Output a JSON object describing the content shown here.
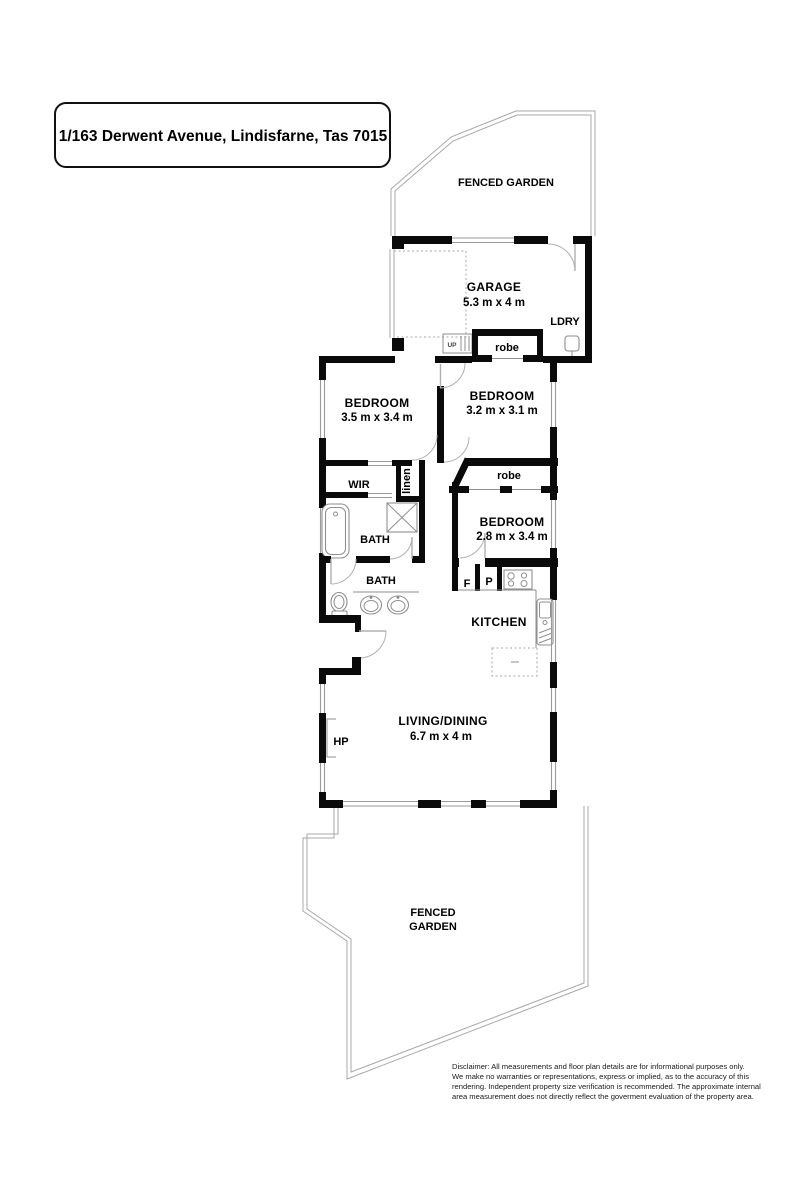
{
  "title": "1/163 Derwent Avenue, Lindisfarne, Tas 7015",
  "garden_top_label": "FENCED GARDEN",
  "garden_bottom_label_1": "FENCED",
  "garden_bottom_label_2": "GARDEN",
  "rooms": {
    "garage": {
      "name": "GARAGE",
      "dims": "5.3 m x 4 m"
    },
    "bedroom1": {
      "name": "BEDROOM",
      "dims": "3.5 m x 3.4 m"
    },
    "bedroom2": {
      "name": "BEDROOM",
      "dims": "3.2 m x 3.1 m"
    },
    "bedroom3": {
      "name": "BEDROOM",
      "dims": "2.8 m x 3.4 m"
    },
    "living": {
      "name": "LIVING/DINING",
      "dims": "6.7 m x 4 m"
    },
    "kitchen": {
      "name": "KITCHEN"
    },
    "bath_main": {
      "name": "BATH"
    },
    "bath_two": {
      "name": "BATH"
    },
    "laundry": {
      "name": "LDRY"
    },
    "wir": {
      "name": "WIR"
    }
  },
  "labels": {
    "robe_garage": "robe",
    "robe_bedroom": "robe",
    "linen": "linen",
    "stairs": "UP",
    "fridge": "F",
    "pantry": "P",
    "heat_pump": "HP"
  },
  "disclaimer": {
    "line1": "Disclaimer: All measurements and floor plan details are for informational purposes only.",
    "line2": "We  make no warranties or representations, express or implied, as to the accuracy of this",
    "line3": "rendering. Independent property size verification is recommended. The approximate internal",
    "line4": "area measurement does not directly reflect the goverment evaluation of the property area."
  },
  "colors": {
    "wall": "#0a0a0a",
    "thin_line": "#999999",
    "background": "#ffffff"
  }
}
